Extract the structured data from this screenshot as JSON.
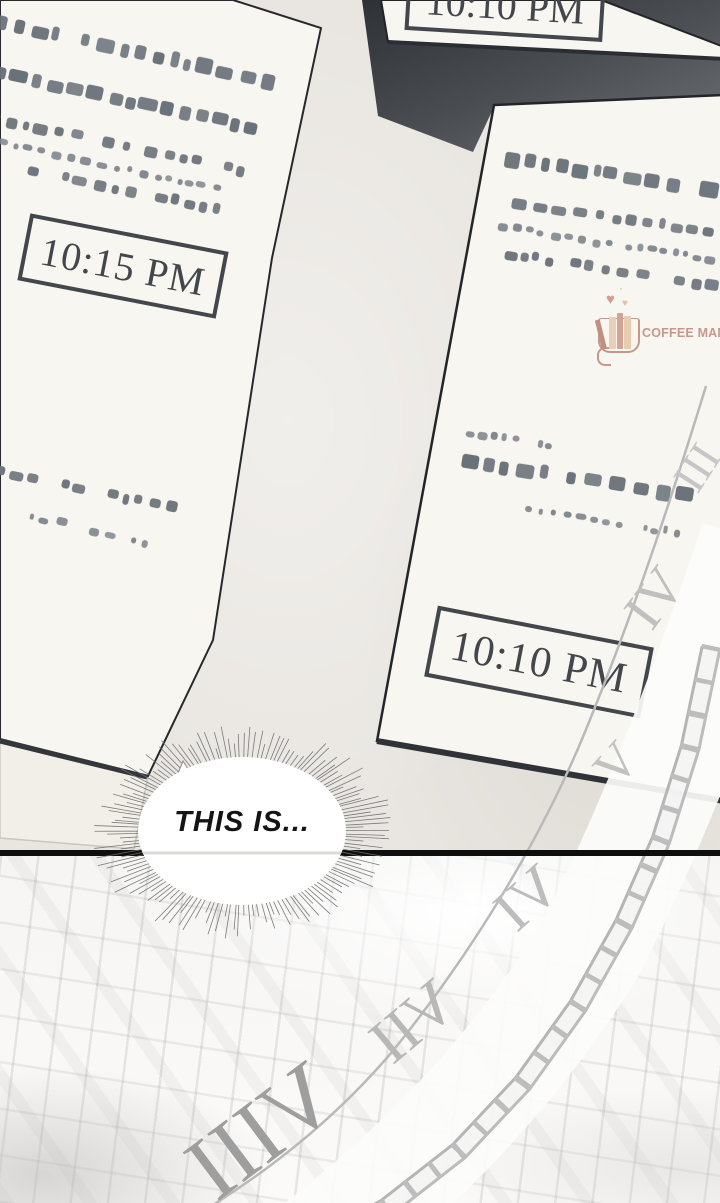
{
  "papers": {
    "top": {
      "time": "10:10 PM"
    },
    "left": {
      "time": "10:15 PM"
    },
    "right": {
      "time": "10:10 PM"
    }
  },
  "redacted": {
    "left": [
      {
        "x": -8,
        "y": 14,
        "w": 290,
        "s": "lg",
        "rot": 12
      },
      {
        "x": -8,
        "y": 64,
        "w": 285,
        "s": "lg",
        "rot": 12
      },
      {
        "x": -10,
        "y": 112,
        "w": 262,
        "s": "md",
        "rot": 12
      },
      {
        "x": -2,
        "y": 138,
        "w": 240,
        "s": "sm",
        "rot": 12
      },
      {
        "x": 28,
        "y": 164,
        "w": 205,
        "s": "md",
        "rot": 12
      },
      {
        "x": -6,
        "y": 465,
        "w": 200,
        "s": "md",
        "rot": 12
      },
      {
        "x": 30,
        "y": 512,
        "w": 135,
        "s": "sm",
        "rot": 13
      }
    ],
    "right": [
      {
        "x": 505,
        "y": 150,
        "w": 215,
        "s": "lg",
        "rot": 9
      },
      {
        "x": 512,
        "y": 196,
        "w": 208,
        "s": "md",
        "rot": 9
      },
      {
        "x": 498,
        "y": 222,
        "w": 222,
        "s": "sm",
        "rot": 9
      },
      {
        "x": 505,
        "y": 248,
        "w": 215,
        "s": "md",
        "rot": 9
      },
      {
        "x": 466,
        "y": 428,
        "w": 95,
        "s": "sm",
        "rot": 9
      },
      {
        "x": 462,
        "y": 452,
        "w": 242,
        "s": "lg",
        "rot": 9
      },
      {
        "x": 525,
        "y": 505,
        "w": 160,
        "s": "sm",
        "rot": 9
      }
    ]
  },
  "bubble": {
    "text": "THIS IS..."
  },
  "watermark": {
    "text": "COFFEE MANGA"
  },
  "clock": {
    "numerals_far": [
      "III",
      "IV",
      "V"
    ],
    "numerals_near": [
      "VI",
      "VII",
      "VIII"
    ]
  },
  "colors": {
    "paper": "#f8f6f1",
    "ink": "#43464b",
    "dark_background": "#3a3d42",
    "clock_gray": "#bfbfbf",
    "logo_rose": "#c5988a",
    "logo_tan": "#dfc2a9"
  }
}
